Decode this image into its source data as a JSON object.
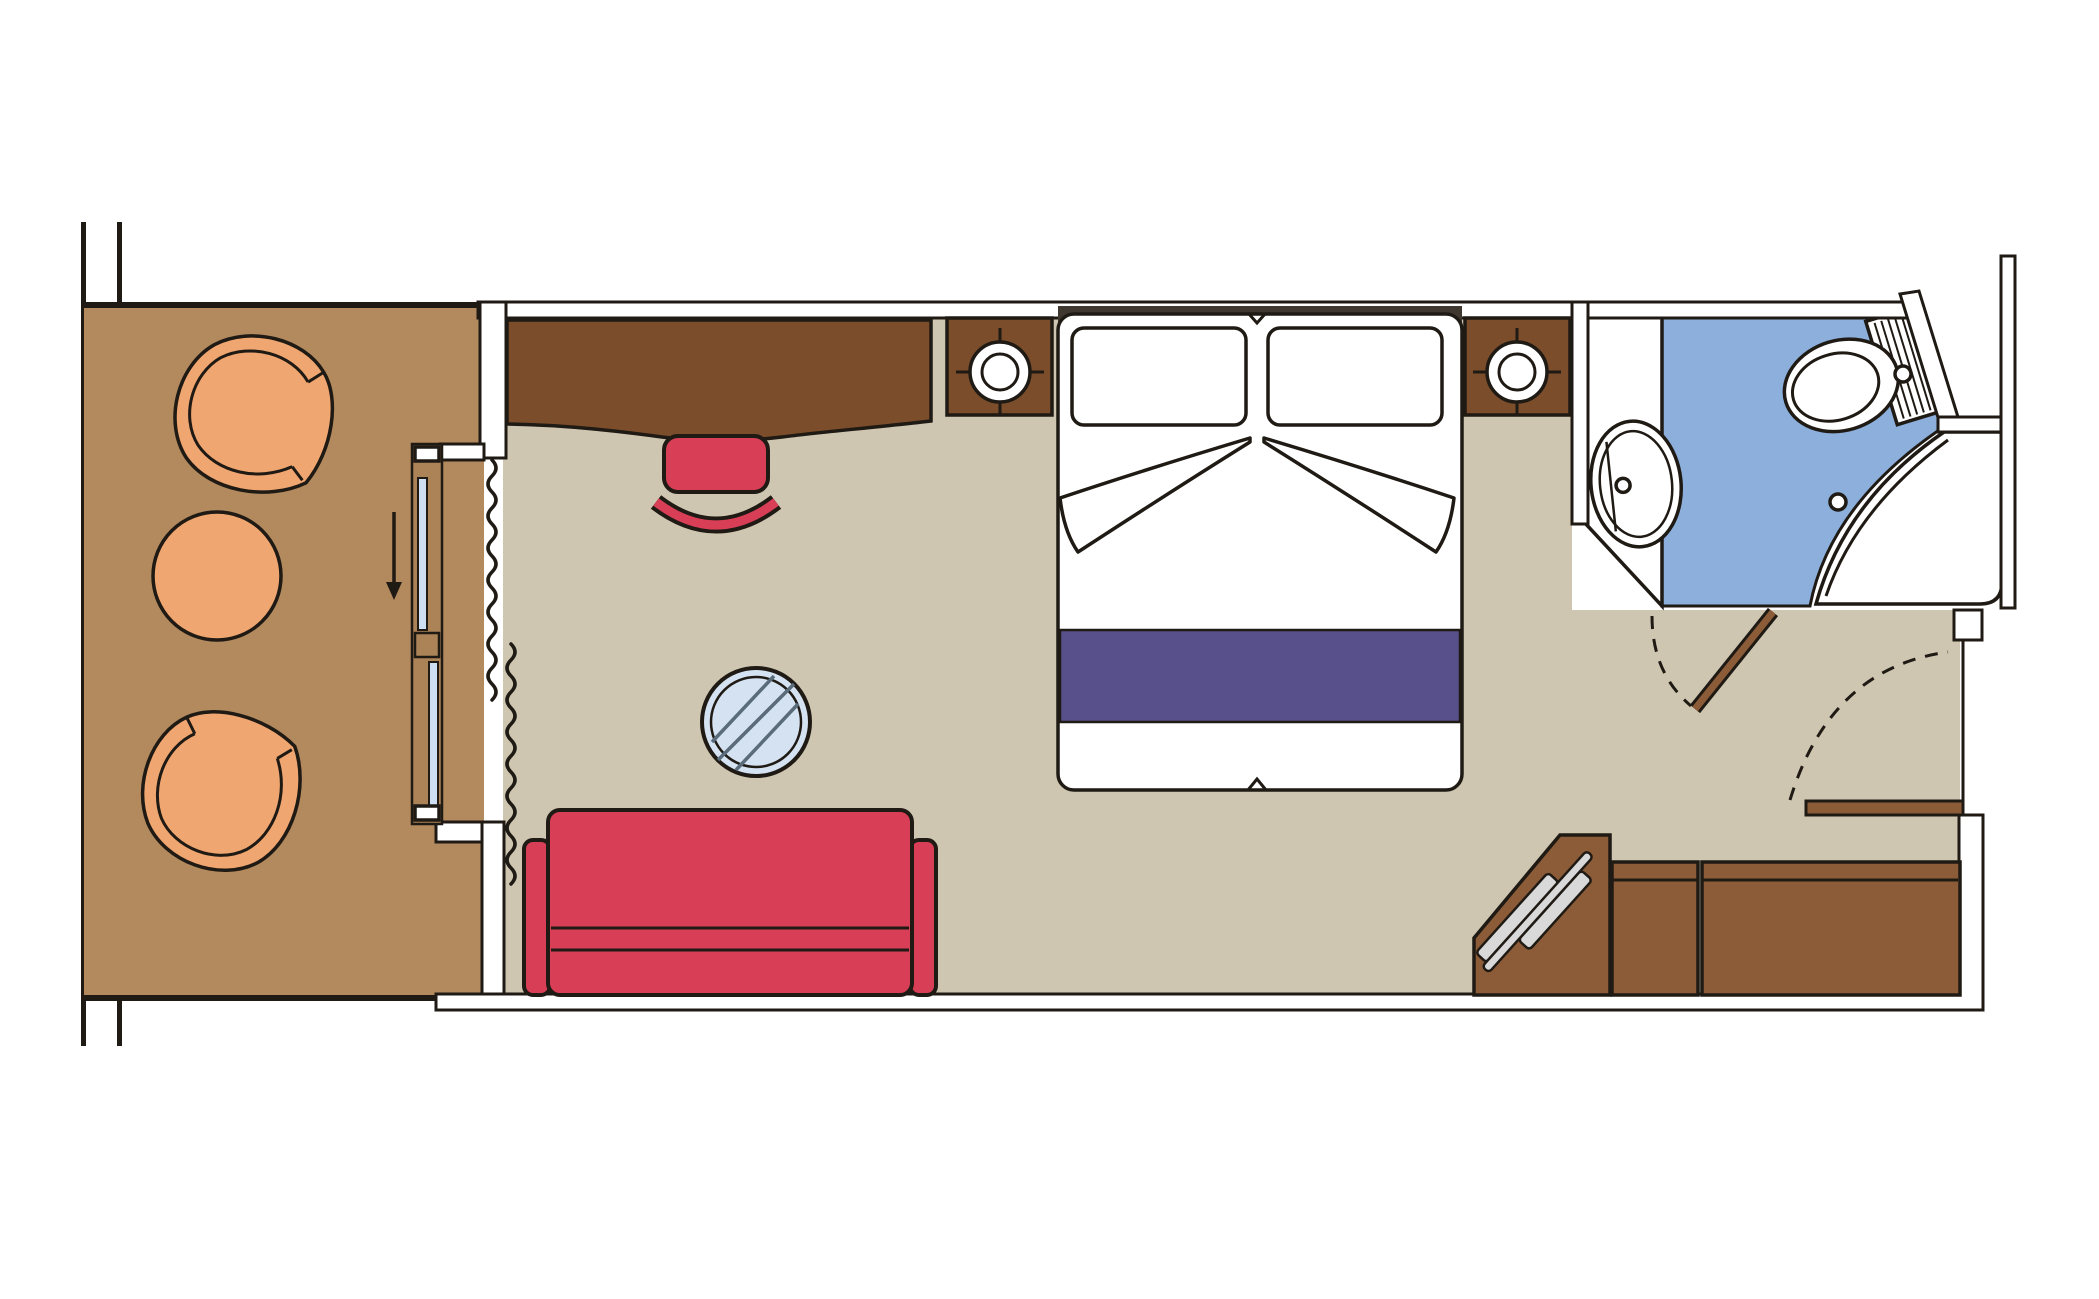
{
  "document": {
    "type": "floor-plan",
    "subject": "cruise-ship-balcony-cabin"
  },
  "colors": {
    "outline": "#1f1a14",
    "balcony_floor": "#b3895e",
    "cabin_floor": "#cfc6b1",
    "bathroom_floor": "#8cafdc",
    "furniture_wood_dark": "#7b4d2b",
    "furniture_wood_mid": "#8c5c38",
    "frame_wood": "#ab8356",
    "upholstery_red": "#d83f57",
    "bed_purple": "#57508a",
    "chair_peach": "#f0a670",
    "glass_blue": "#cddff1",
    "hatch_gray": "#d9d9d9",
    "headboard_dark": "#3e3831",
    "table_glass": "#d4e2f2",
    "table_hatch": "#5a6b7a"
  },
  "rooms": [
    {
      "name": "balcony",
      "items": [
        "armchair",
        "round-table",
        "armchair",
        "sliding-glass-door",
        "curtain",
        "slide-direction-arrow"
      ]
    },
    {
      "name": "cabin",
      "items": [
        "desk",
        "stool",
        "nightstand-lamp",
        "double-bed",
        "nightstand-lamp",
        "sofa",
        "glass-coffee-table",
        "wardrobe-rail-unit",
        "wardrobe-cabinets"
      ]
    },
    {
      "name": "bathroom",
      "items": [
        "vanity-sink",
        "toilet",
        "shower",
        "bathroom-door"
      ]
    },
    {
      "name": "corridor",
      "items": [
        "entry-door"
      ]
    }
  ]
}
